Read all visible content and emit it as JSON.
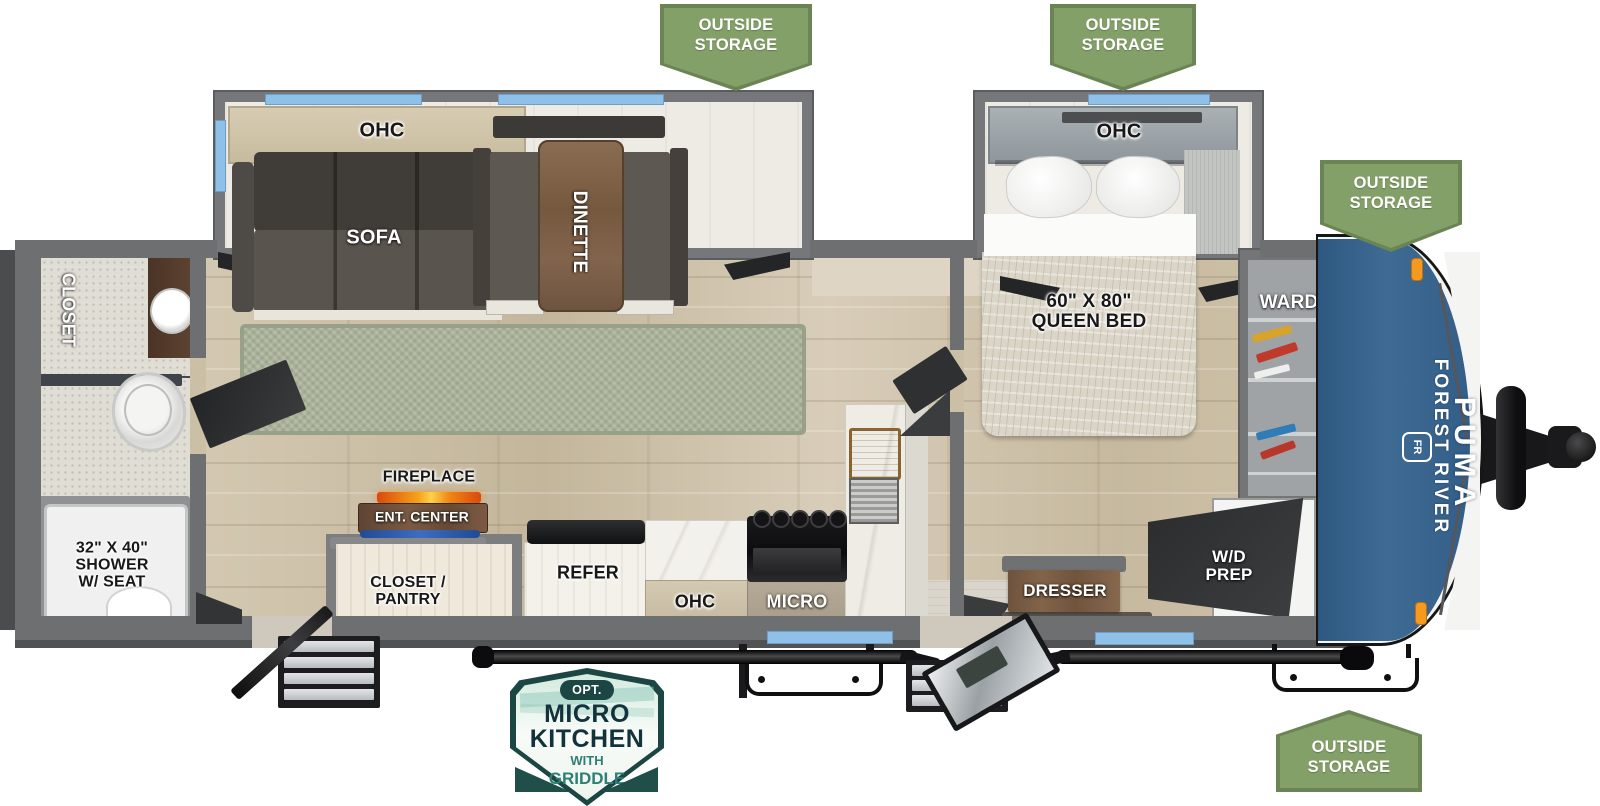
{
  "colors": {
    "banner_green": "#84a069",
    "banner_green_dark": "#6b8454",
    "cap_blue": "#3a6690",
    "badge_teal": "#1c4643",
    "badge_accent": "#2d7f74",
    "window_blue": "#8fc0e8",
    "marker_orange": "#f59a1e"
  },
  "banners": {
    "outside_storage": "OUTSIDE STORAGE"
  },
  "living_slide": {
    "ohc": "OHC",
    "sofa": "SOFA",
    "dinette": "DINETTE"
  },
  "bedroom": {
    "ohc": "OHC",
    "bed_size": "60\" X 80\"",
    "bed_name": "QUEEN BED",
    "ward": "WARD",
    "dresser": "DRESSER",
    "wd_prep_line1": "W/D",
    "wd_prep_line2": "PREP"
  },
  "bathroom": {
    "closet": "CLOSET",
    "shower_size": "32\" X 40\"",
    "shower_line2": "SHOWER",
    "shower_line3": "W/ SEAT"
  },
  "kitchen": {
    "fireplace": "FIREPLACE",
    "ent_center": "ENT. CENTER",
    "pantry_line1": "CLOSET /",
    "pantry_line2": "PANTRY",
    "refer": "REFER",
    "ohc": "OHC",
    "micro": "MICRO"
  },
  "front_cap": {
    "maker": "FOREST RIVER",
    "model": "PUMA",
    "logo": "FR"
  },
  "badge": {
    "opt": "OPT.",
    "line1": "MICRO",
    "line2": "KITCHEN",
    "line3": "WITH",
    "line4": "GRIDDLE"
  }
}
